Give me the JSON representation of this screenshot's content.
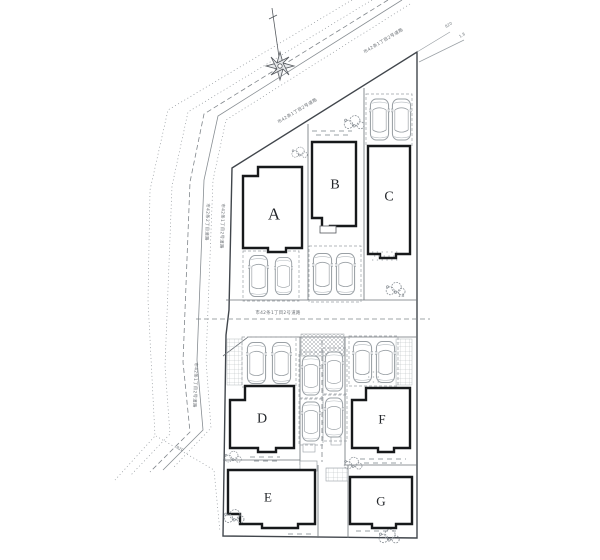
{
  "plan": {
    "title": "site-plan",
    "lots": [
      {
        "label": "A"
      },
      {
        "label": "B"
      },
      {
        "label": "C"
      },
      {
        "label": "D"
      },
      {
        "label": "E"
      },
      {
        "label": "F"
      },
      {
        "label": "G"
      }
    ],
    "roads": {
      "diagonal_upper": "市42条1丁目2号道路",
      "diagonal_lower": "市42条1丁目2号道路",
      "left_outer": "市42条2丁目道路",
      "left_inner": "市42条1丁目2号道路",
      "left_lower": "市42条1丁目2号道路",
      "middle": "市42条1丁目2号道路"
    },
    "dims": {
      "d1": "820",
      "d2": "1.8",
      "d3": "820",
      "d4": "1.8"
    },
    "colors": {
      "paper": "#ffffff",
      "line": "#7c8288",
      "boundary": "#41464c",
      "building": "#17191b",
      "text": "#23262a"
    }
  }
}
